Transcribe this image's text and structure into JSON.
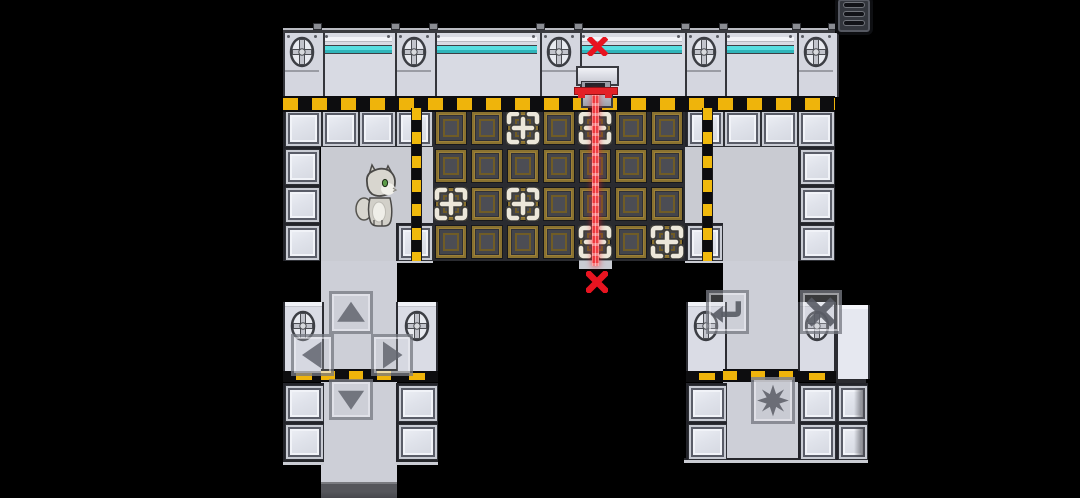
{
  "scene": {
    "description": "Sci-fi tile-based puzzle room with cat character, crate grid, laser beam and touch controls",
    "background_color": "#000000"
  },
  "palette": {
    "wall_light": "#dfe2ea",
    "interior_gray": "#c9cbd2",
    "crate_face": "#44454b",
    "crate_frame_bronze": "#8a7230",
    "hazard_yellow": "#efb40b",
    "accent_cyan": "#4fd8da",
    "laser_red": "#e6171f",
    "blocked_x_red": "#e81420"
  },
  "hud": {
    "menu_button": {
      "icon": "hamburger-menu-icon",
      "slots": 3
    }
  },
  "level": {
    "crate_grid": {
      "cols": 7,
      "rows": 4,
      "marker_cells": [
        {
          "row": 1,
          "col": 3
        },
        {
          "row": 1,
          "col": 5
        },
        {
          "row": 3,
          "col": 1
        },
        {
          "row": 3,
          "col": 3
        },
        {
          "row": 4,
          "col": 5
        },
        {
          "row": 4,
          "col": 7
        }
      ]
    },
    "laser": {
      "grid_column": 5,
      "orientation": "vertical",
      "top_marker": "red-x",
      "bottom_marker": "red-x"
    },
    "character": {
      "species": "cat",
      "color": "gray-white",
      "eyes": "green",
      "facing": "right"
    },
    "portholes_top_wall": 5,
    "portholes_legs": 4
  },
  "controls": {
    "dpad": [
      {
        "id": "up",
        "glyph": "triangle-up"
      },
      {
        "id": "left",
        "glyph": "triangle-left"
      },
      {
        "id": "right",
        "glyph": "triangle-right"
      },
      {
        "id": "down",
        "glyph": "triangle-down"
      }
    ],
    "actions": [
      {
        "id": "undo",
        "glyph": "return-arrow"
      },
      {
        "id": "close",
        "glyph": "x-mark"
      },
      {
        "id": "interact",
        "glyph": "eight-point-star"
      }
    ]
  }
}
